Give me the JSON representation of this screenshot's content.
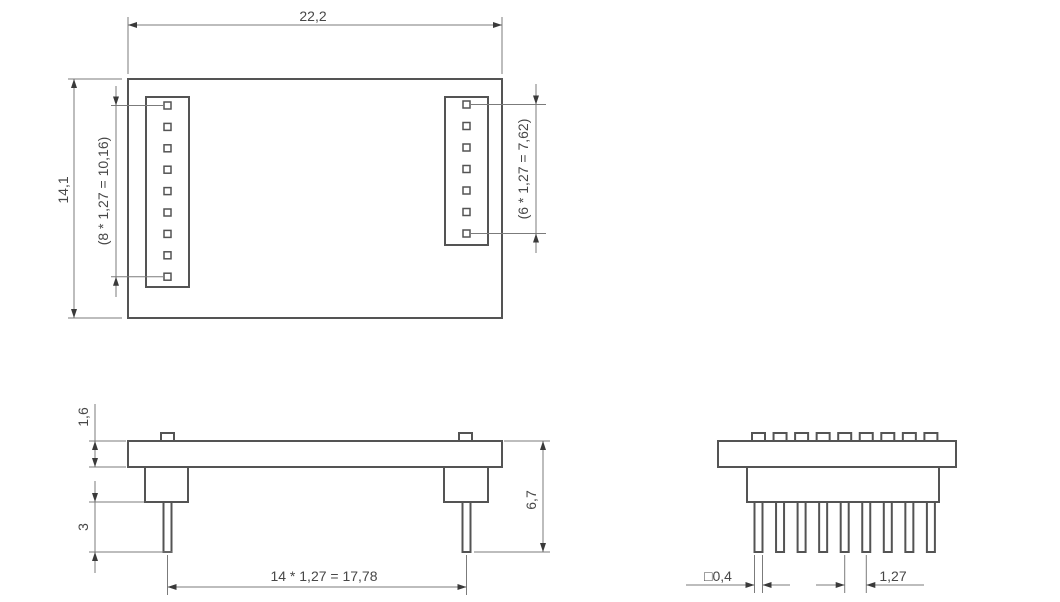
{
  "colors": {
    "background": "#ffffff",
    "outline": "#545454",
    "dimension_line": "#7b7b7b",
    "text": "#474747",
    "arrow": "#3a3a3a"
  },
  "top_view": {
    "left_pin_count": 9,
    "right_pin_count": 7,
    "dims": {
      "width": "22,2",
      "height": "14,1",
      "left_pin_span": "(8 * 1,27 = 10,16)",
      "right_pin_span": "(6 * 1,27 = 7,62)"
    }
  },
  "front_view": {
    "dims": {
      "board_thickness": "1,6",
      "pin_protrusion": "3",
      "overall_height": "6,7",
      "pin_row_span": "14 * 1,27 = 17,78"
    }
  },
  "side_view": {
    "pin_count": 9,
    "dims": {
      "pin_square": "□0,4",
      "pin_pitch": "1,27"
    }
  }
}
